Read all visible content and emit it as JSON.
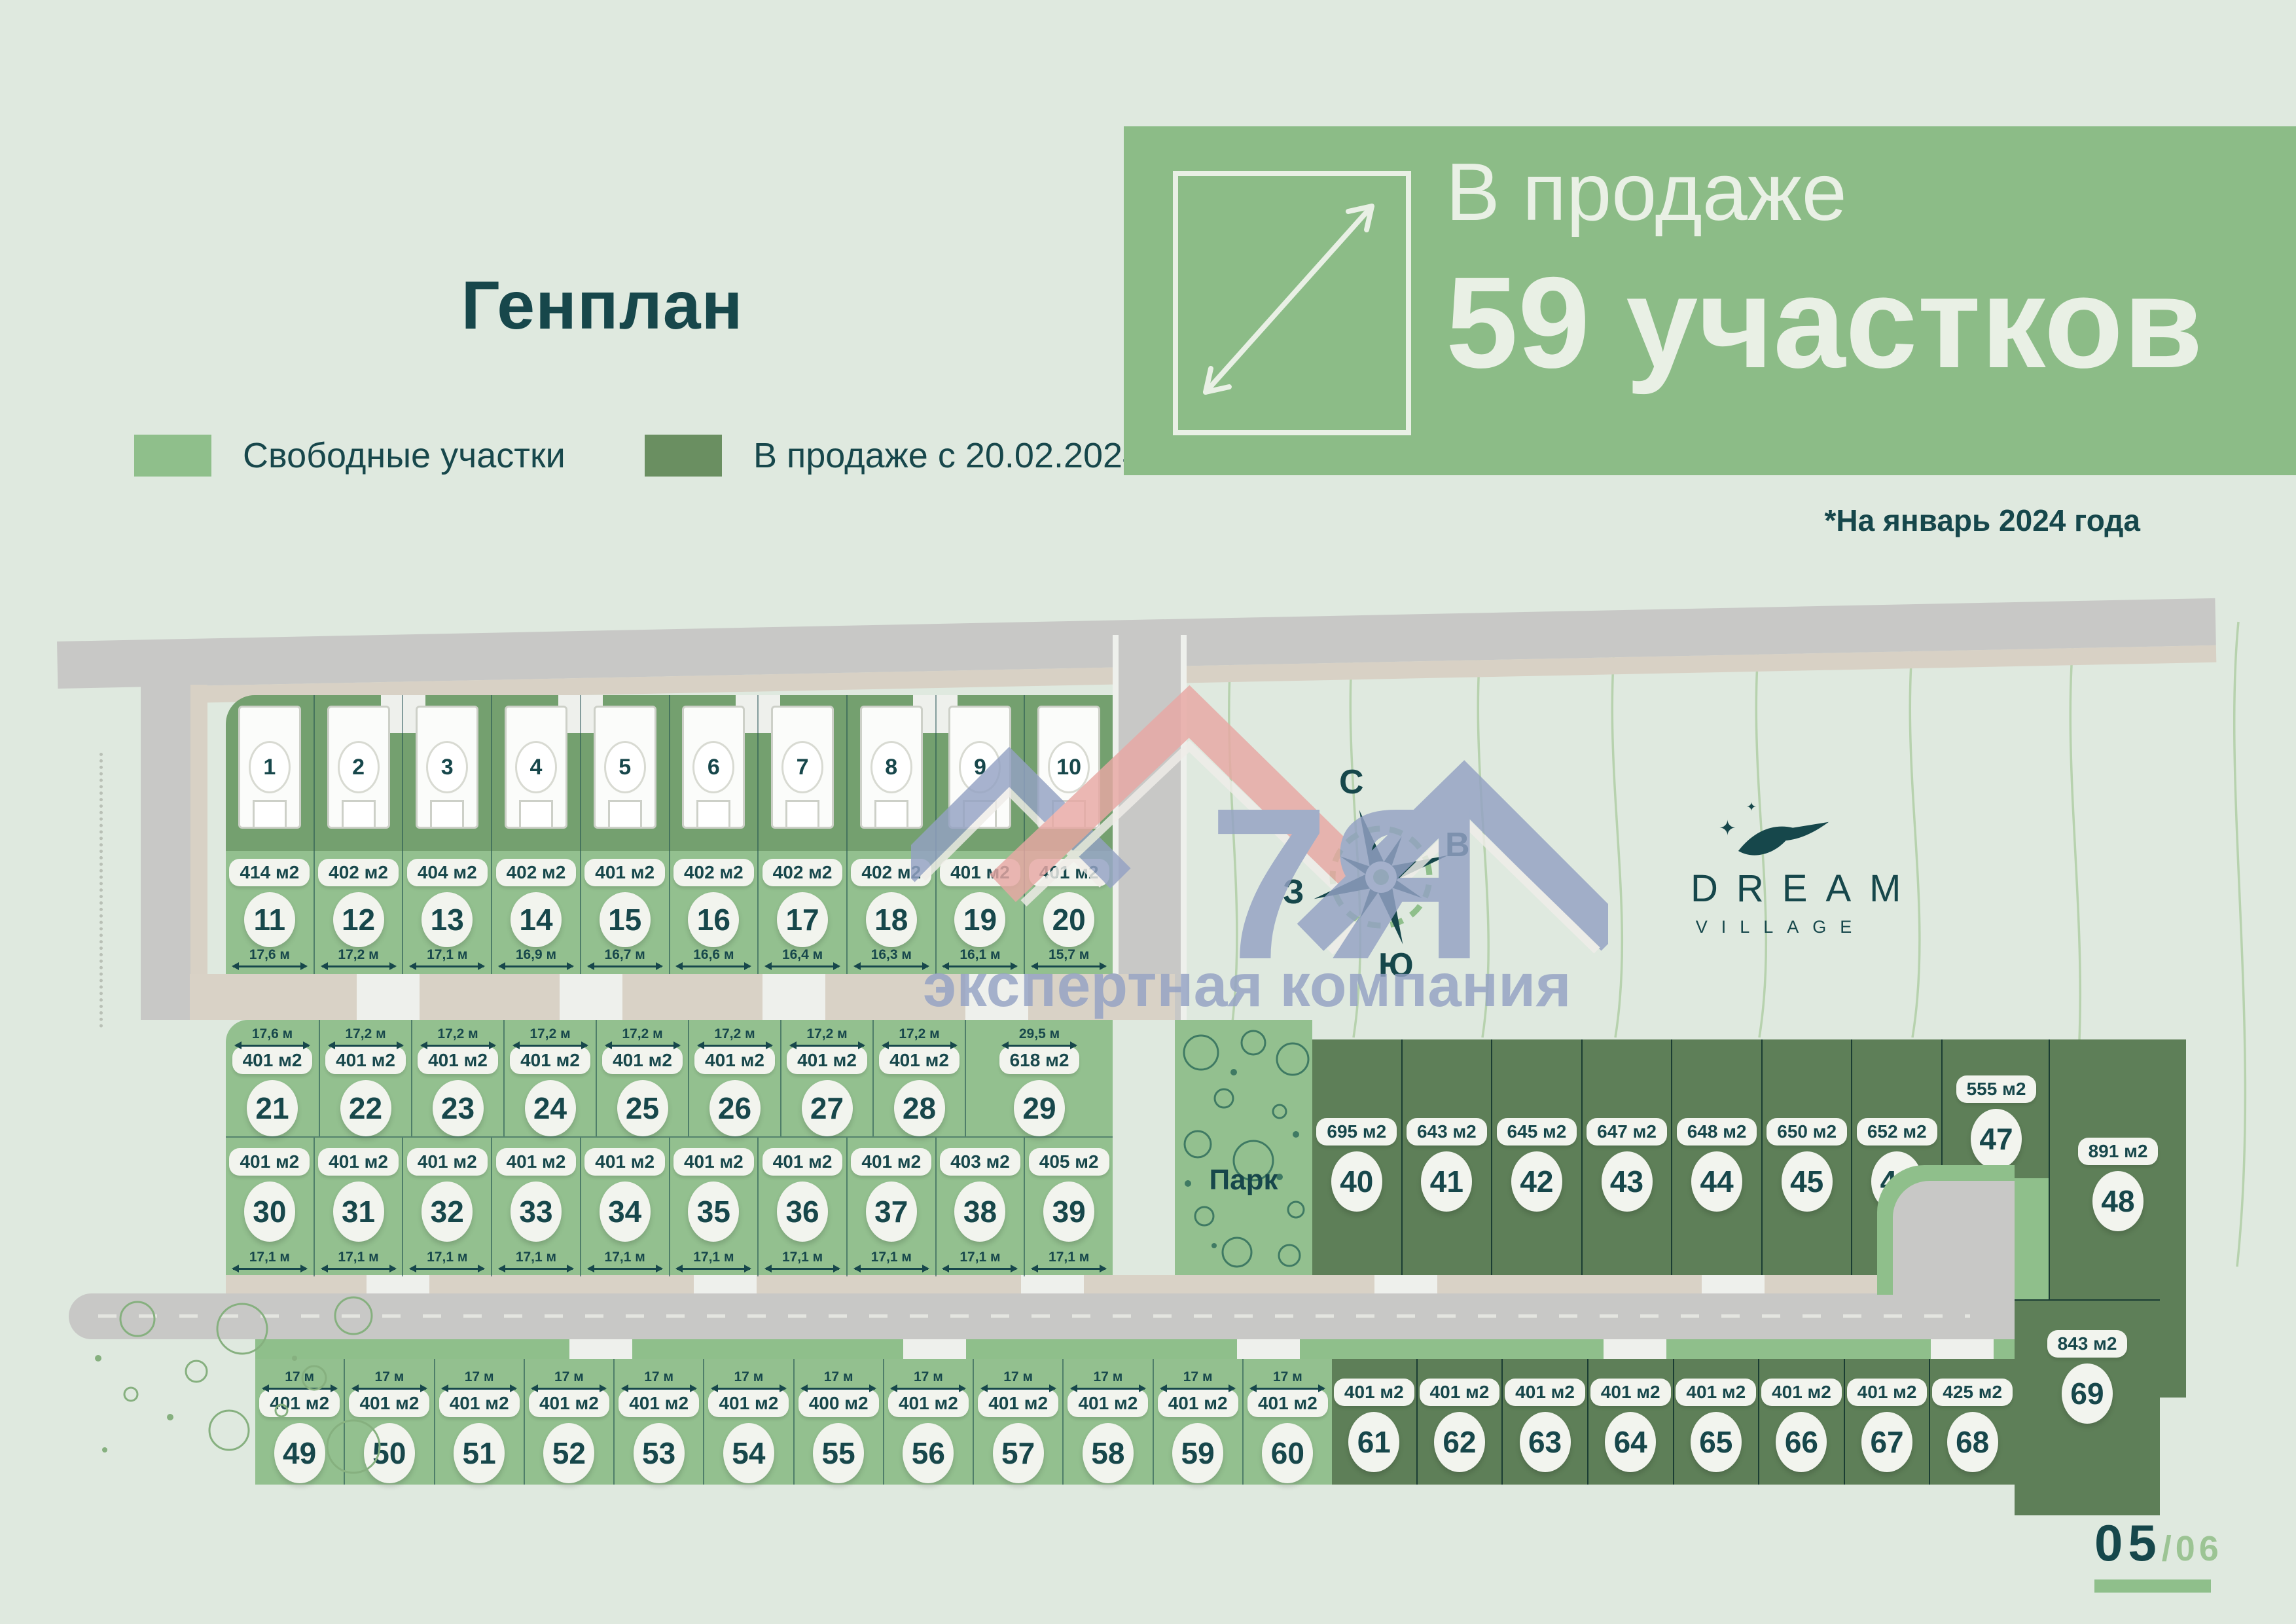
{
  "header": {
    "title": "Генплан",
    "legend": [
      {
        "label": "Свободные участки",
        "color": "#8fbf8b"
      },
      {
        "label": "В продаже с 20.02.2024",
        "color": "#6a8f61"
      }
    ],
    "banner": {
      "line1": "В продаже",
      "line2": "59 участков",
      "note": "*На январь 2024 года",
      "bg": "#8cbc87"
    }
  },
  "plan": {
    "park_label": "Парк",
    "compass": {
      "north": "С",
      "east": "В",
      "south": "Ю",
      "west": "З"
    },
    "brand": {
      "name": "DREAM",
      "sub": "VILLAGE"
    },
    "watermark": {
      "big": "7Я",
      "small": "экспертная компания"
    },
    "houses": [
      "1",
      "2",
      "3",
      "4",
      "5",
      "6",
      "7",
      "8",
      "9",
      "10"
    ],
    "plots": {
      "row_11_20": [
        {
          "n": "11",
          "area": "414 м2",
          "width": "17,6 м"
        },
        {
          "n": "12",
          "area": "402 м2",
          "width": "17,2 м"
        },
        {
          "n": "13",
          "area": "404 м2",
          "width": "17,1 м"
        },
        {
          "n": "14",
          "area": "402 м2",
          "width": "16,9 м"
        },
        {
          "n": "15",
          "area": "401 м2",
          "width": "16,7 м"
        },
        {
          "n": "16",
          "area": "402 м2",
          "width": "16,6 м"
        },
        {
          "n": "17",
          "area": "402 м2",
          "width": "16,4 м"
        },
        {
          "n": "18",
          "area": "402 м2",
          "width": "16,3 м"
        },
        {
          "n": "19",
          "area": "401 м2",
          "width": "16,1 м"
        },
        {
          "n": "20",
          "area": "401 м2",
          "width": "15,7 м"
        }
      ],
      "row_21_29": [
        {
          "n": "21",
          "area": "401 м2",
          "width": "17,6 м"
        },
        {
          "n": "22",
          "area": "401 м2",
          "width": "17,2 м"
        },
        {
          "n": "23",
          "area": "401 м2",
          "width": "17,2 м"
        },
        {
          "n": "24",
          "area": "401 м2",
          "width": "17,2 м"
        },
        {
          "n": "25",
          "area": "401 м2",
          "width": "17,2 м"
        },
        {
          "n": "26",
          "area": "401 м2",
          "width": "17,2 м"
        },
        {
          "n": "27",
          "area": "401 м2",
          "width": "17,2 м"
        },
        {
          "n": "28",
          "area": "401 м2",
          "width": "17,2 м"
        },
        {
          "n": "29",
          "area": "618 м2",
          "width": "29,5 м"
        }
      ],
      "row_30_39": [
        {
          "n": "30",
          "area": "401 м2",
          "width": "17,1 м"
        },
        {
          "n": "31",
          "area": "401 м2",
          "width": "17,1 м"
        },
        {
          "n": "32",
          "area": "401 м2",
          "width": "17,1 м"
        },
        {
          "n": "33",
          "area": "401 м2",
          "width": "17,1 м"
        },
        {
          "n": "34",
          "area": "401 м2",
          "width": "17,1 м"
        },
        {
          "n": "35",
          "area": "401 м2",
          "width": "17,1 м"
        },
        {
          "n": "36",
          "area": "401 м2",
          "width": "17,1 м"
        },
        {
          "n": "37",
          "area": "401 м2",
          "width": "17,1 м"
        },
        {
          "n": "38",
          "area": "403 м2",
          "width": "17,1 м"
        },
        {
          "n": "39",
          "area": "405 м2",
          "width": "17,1 м"
        }
      ],
      "row_40_46": [
        {
          "n": "40",
          "area": "695 м2"
        },
        {
          "n": "41",
          "area": "643 м2"
        },
        {
          "n": "42",
          "area": "645 м2"
        },
        {
          "n": "43",
          "area": "647 м2"
        },
        {
          "n": "44",
          "area": "648 м2"
        },
        {
          "n": "45",
          "area": "650 м2"
        },
        {
          "n": "46",
          "area": "652 м2"
        }
      ],
      "plot_47": {
        "n": "47",
        "area": "555 м2"
      },
      "plot_48": {
        "n": "48",
        "area": "891 м2"
      },
      "row_49_60": [
        {
          "n": "49",
          "area": "401 м2",
          "width": "17 м"
        },
        {
          "n": "50",
          "area": "401 м2",
          "width": "17 м"
        },
        {
          "n": "51",
          "area": "401 м2",
          "width": "17 м"
        },
        {
          "n": "52",
          "area": "401 м2",
          "width": "17 м"
        },
        {
          "n": "53",
          "area": "401 м2",
          "width": "17 м"
        },
        {
          "n": "54",
          "area": "401 м2",
          "width": "17 м"
        },
        {
          "n": "55",
          "area": "400 м2",
          "width": "17 м"
        },
        {
          "n": "56",
          "area": "401 м2",
          "width": "17 м"
        },
        {
          "n": "57",
          "area": "401 м2",
          "width": "17 м"
        },
        {
          "n": "58",
          "area": "401 м2",
          "width": "17 м"
        },
        {
          "n": "59",
          "area": "401 м2",
          "width": "17 м"
        },
        {
          "n": "60",
          "area": "401 м2",
          "width": "17 м"
        }
      ],
      "row_61_68": [
        {
          "n": "61",
          "area": "401 м2"
        },
        {
          "n": "62",
          "area": "401 м2"
        },
        {
          "n": "63",
          "area": "401 м2"
        },
        {
          "n": "64",
          "area": "401 м2"
        },
        {
          "n": "65",
          "area": "401 м2"
        },
        {
          "n": "66",
          "area": "401 м2"
        },
        {
          "n": "67",
          "area": "401 м2"
        },
        {
          "n": "68",
          "area": "425 м2"
        }
      ],
      "plot_69": {
        "n": "69",
        "area": "843 м2"
      }
    },
    "colors": {
      "free": "#93c08f",
      "sale": "#5e7f58",
      "house_lot": "#74a06f",
      "road": "#c8c8c6",
      "sidewalk": "#d9d2c6",
      "ink": "#17474b",
      "banner_green": "#8cbc87"
    }
  },
  "footer": {
    "page": "05",
    "total": "/06"
  }
}
